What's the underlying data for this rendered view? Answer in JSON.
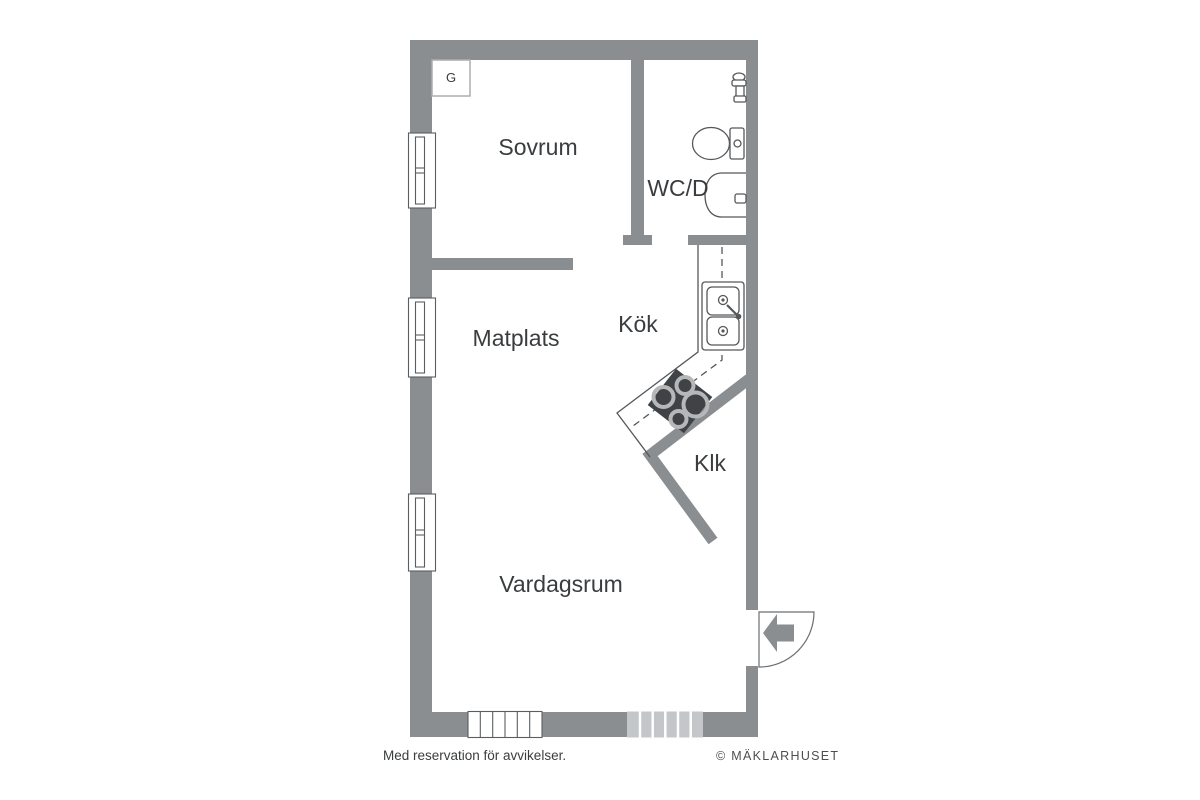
{
  "floorplan": {
    "rooms": [
      {
        "id": "sovrum",
        "label": "Sovrum"
      },
      {
        "id": "wcd",
        "label": "WC/D"
      },
      {
        "id": "matplats",
        "label": "Matplats"
      },
      {
        "id": "kok",
        "label": "Kök"
      },
      {
        "id": "klk",
        "label": "Klk"
      },
      {
        "id": "vardagsrum",
        "label": "Vardagsrum"
      }
    ],
    "closet": {
      "label": "G"
    },
    "fixtures": {
      "shower_mixer": "shower-mixer",
      "toilet": "toilet",
      "washbasin": "washbasin",
      "kitchen_sink": "double-basin-sink-with-faucet",
      "stove": "stove-4-burners",
      "entrance_door": "door-swing-quarter-arc",
      "entrance_arrow": "entrance-arrow-left"
    },
    "colors": {
      "wall": "#8a8e91",
      "line": "#54585b",
      "stove": "#404345",
      "burner_ring": "#b5b7b9",
      "balcony_window": "#c4c7c9",
      "text": "#3a3d3f"
    }
  },
  "footer": {
    "disclaimer": "Med reservation för avvikelser.",
    "copyright": "© MÄKLARHUSET"
  }
}
